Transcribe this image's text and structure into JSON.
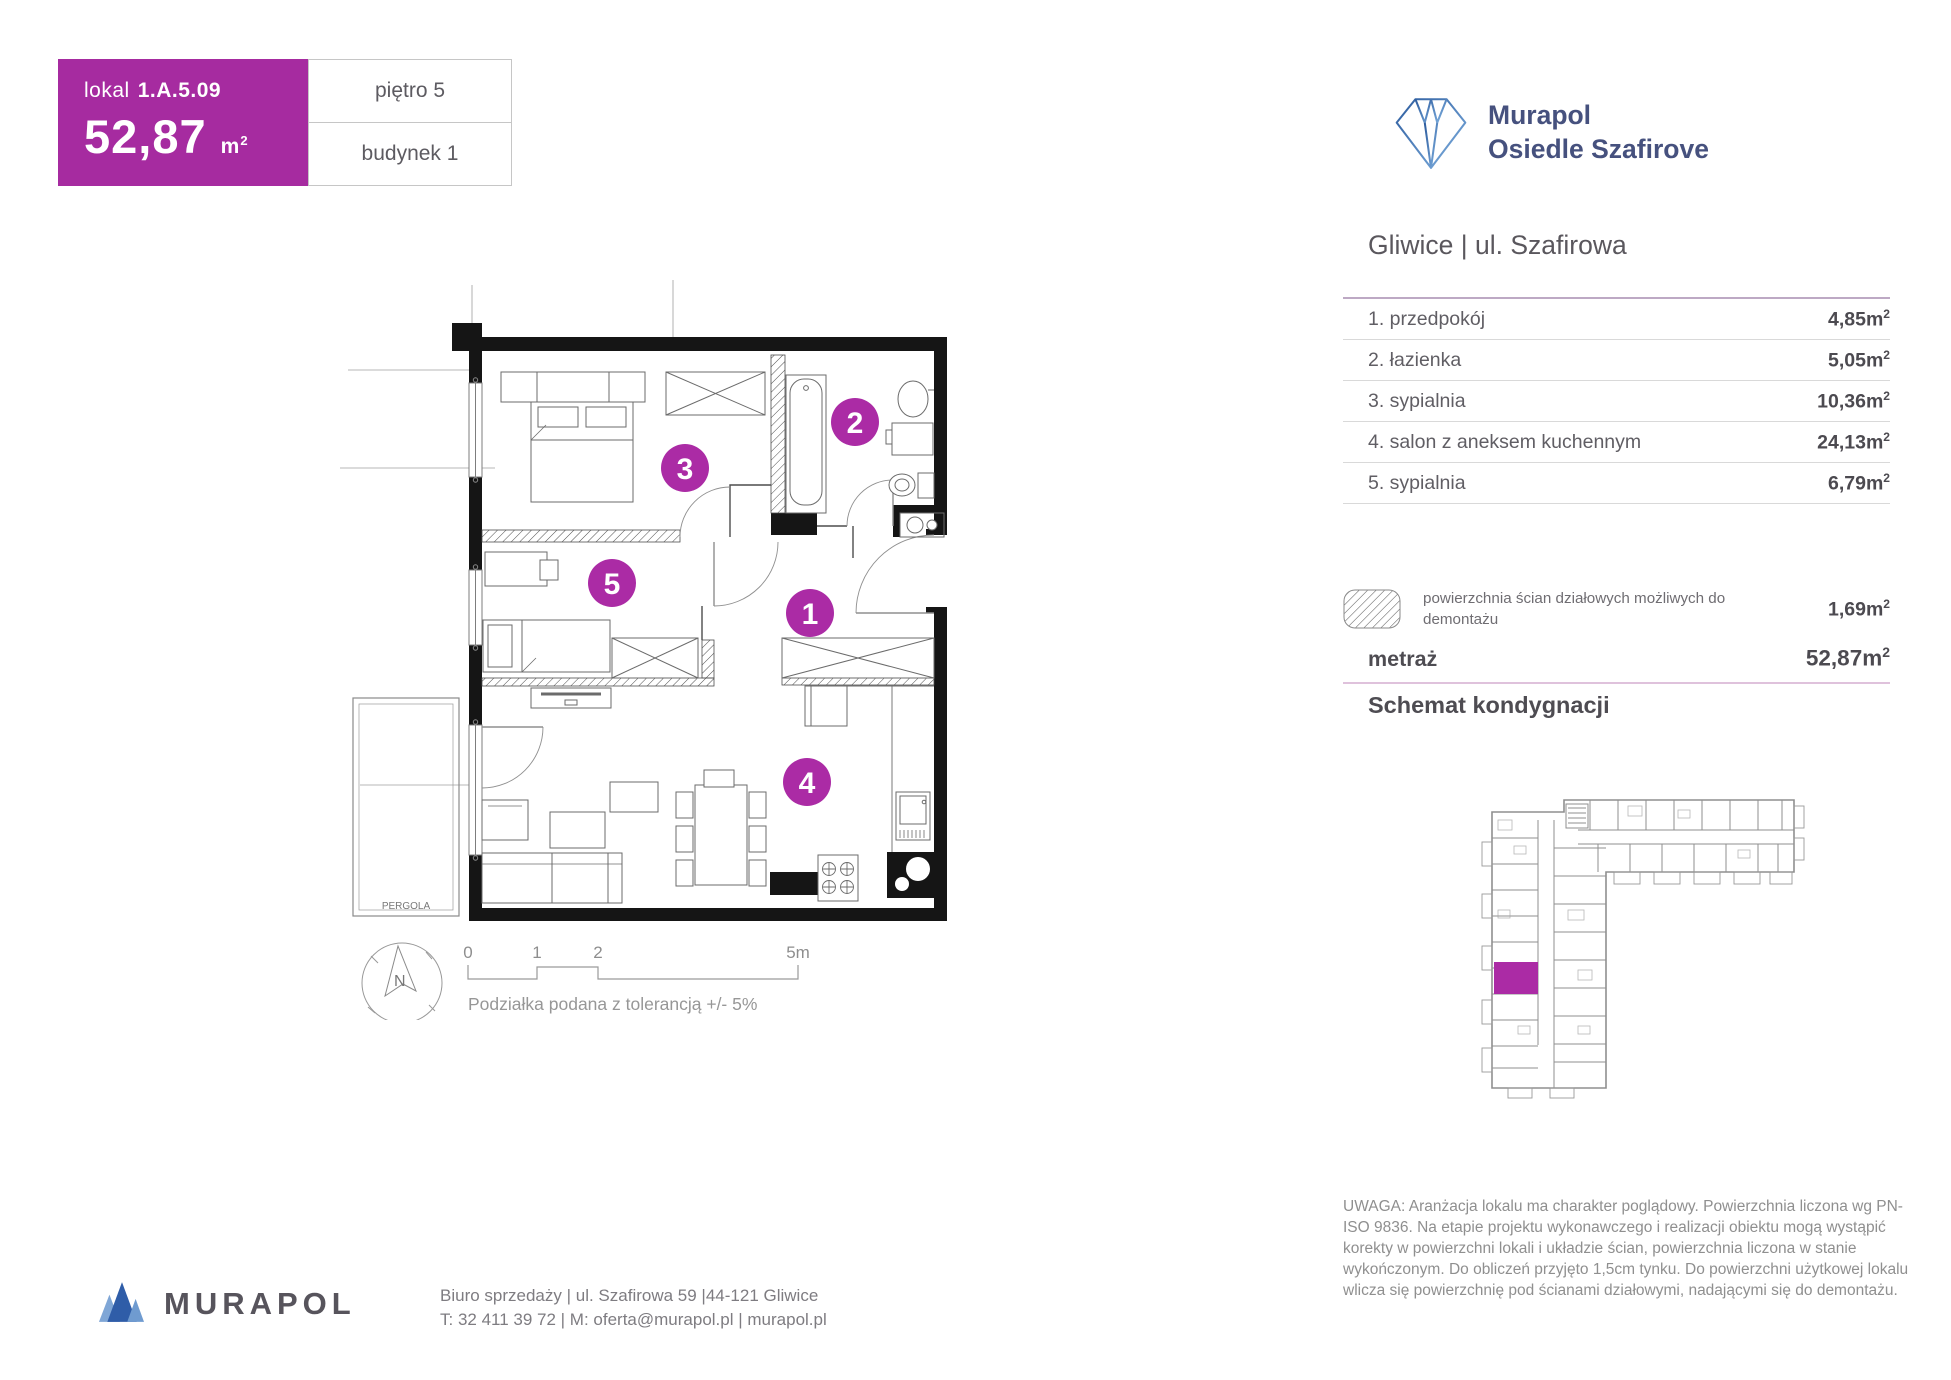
{
  "colors": {
    "magenta": "#a62ba0",
    "circle_magenta": "#ab2ba5",
    "navy": "#46517e",
    "wall": "#151515"
  },
  "unit_card": {
    "label": "lokal",
    "number": "1.A.5.09",
    "area": "52,87"
  },
  "units": {
    "m": "m",
    "exp": "2"
  },
  "floor_box": "piętro 5",
  "building_box": "budynek 1",
  "brand": {
    "name_line1": "Murapol",
    "name_line2": "Osiedle Szafirove"
  },
  "location_heading": "Gliwice | ul. Szafirowa",
  "rooms": [
    {
      "name": "1. przedpokój",
      "area": "4,85"
    },
    {
      "name": "2. łazienka",
      "area": "5,05"
    },
    {
      "name": "3. sypialnia",
      "area": "10,36"
    },
    {
      "name": "4. salon z aneksem kuchennym",
      "area": "24,13"
    },
    {
      "name": "5. sypialnia",
      "area": "6,79"
    }
  ],
  "legend": {
    "text": "powierzchnia ścian działowych możliwych do demontażu",
    "area": "1,69"
  },
  "metraz": {
    "label": "metraż",
    "area": "52,87"
  },
  "schemat_title": "Schemat kondygnacji",
  "plan": {
    "room_numbers": [
      "1",
      "2",
      "3",
      "4",
      "5"
    ],
    "pergola_label": "PERGOLA",
    "compass_n": "N",
    "scale": {
      "t0": "0",
      "t1": "1",
      "t2": "2",
      "t3": "5m",
      "caption": "Podziałka podana z tolerancją +/- 5%"
    }
  },
  "disclaimer": "UWAGA: Aranżacja lokalu ma charakter poglądowy. Powierzchnia liczona wg PN-ISO 9836. Na etapie projektu wykonawczego i realizacji obiektu mogą wystąpić korekty w powierzchni lokali i układzie ścian, powierzchnia liczona w stanie wykończonym. Do obliczeń przyjęto 1,5cm tynku. Do powierzchni użytkowej lokalu wlicza się powierzchnię pod ścianami działowymi, nadającymi się do demontażu.",
  "footer": {
    "brand": "MURAPOL",
    "address_line": "Biuro sprzedaży | ul. Szafirowa 59 |44-121 Gliwice",
    "contact_line": "T: 32 411 39 72 | M: oferta@murapol.pl | murapol.pl"
  }
}
